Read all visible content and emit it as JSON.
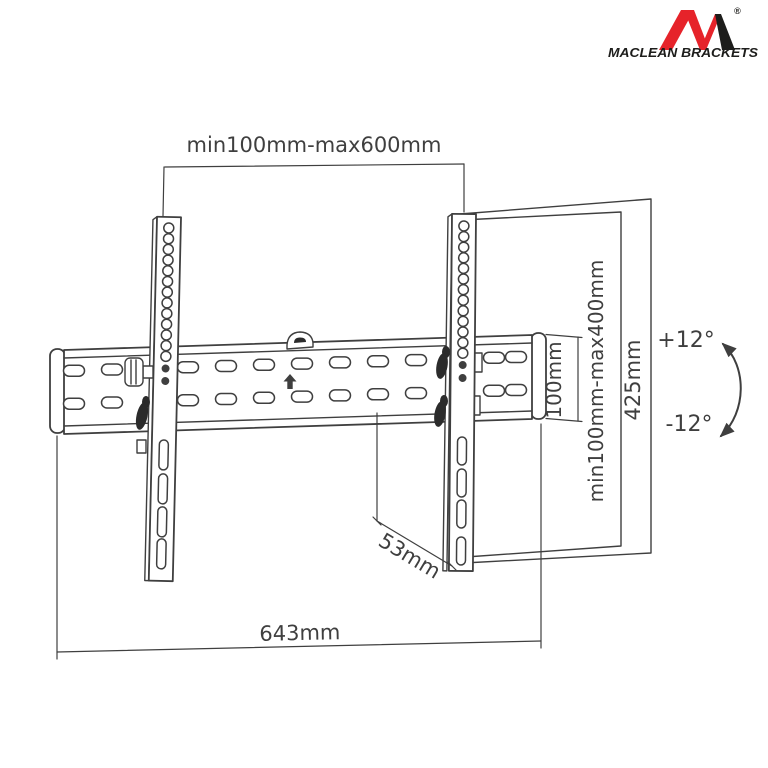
{
  "brand": {
    "name": "MACLEAN BRACKETS",
    "registered_mark": "®"
  },
  "colors": {
    "background": "#ffffff",
    "line": "#3f3f3f",
    "logo_red": "#e6232a",
    "logo_black": "#1d1d1b"
  },
  "diagram": {
    "dimensions": {
      "vesa_width_range": "min100mm-max600mm",
      "vesa_height_range": "min100mm-max400mm",
      "bracket_height": "425mm",
      "rail_height": "100mm",
      "tilt_up": "+12°",
      "tilt_down": "-12°",
      "profile_depth": "53mm",
      "rail_width": "643mm"
    }
  }
}
